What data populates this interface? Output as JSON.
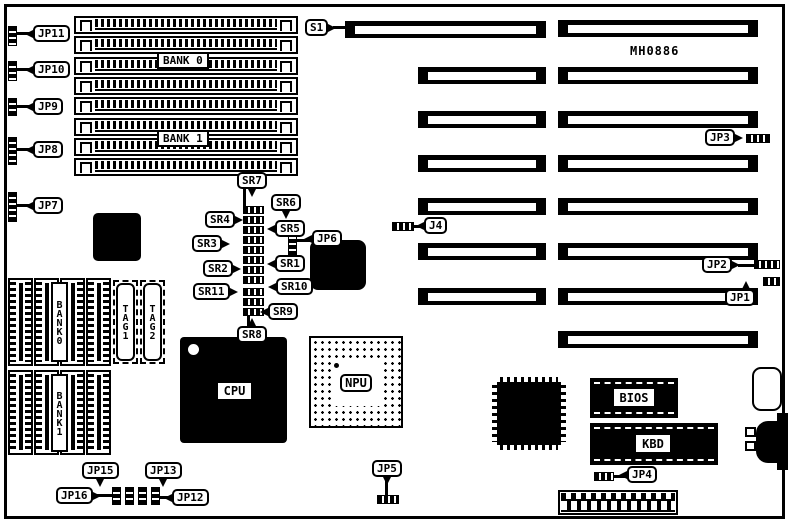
{
  "board": {
    "part_number": "MH0886"
  },
  "callouts": {
    "s1": "S1",
    "j4": "J4",
    "jp1": "JP1",
    "jp2": "JP2",
    "jp3": "JP3",
    "jp4": "JP4",
    "jp5": "JP5",
    "jp6": "JP6",
    "jp7": "JP7",
    "jp8": "JP8",
    "jp9": "JP9",
    "jp10": "JP10",
    "jp11": "JP11",
    "jp12": "JP12",
    "jp13": "JP13",
    "jp15": "JP15",
    "jp16": "JP16"
  },
  "resistor_packs": {
    "sr1": "SR1",
    "sr2": "SR2",
    "sr3": "SR3",
    "sr4": "SR4",
    "sr5": "SR5",
    "sr6": "SR6",
    "sr7": "SR7",
    "sr8": "SR8",
    "sr9": "SR9",
    "sr10": "SR10",
    "sr11": "SR11"
  },
  "memory": {
    "simm_bank0": "BANK 0",
    "simm_bank1": "BANK 1",
    "cache_bank0": "BANK0",
    "cache_bank1": "BANK1",
    "tag1": "TAG1",
    "tag2": "TAG2"
  },
  "chips": {
    "cpu": "CPU",
    "npu": "NPU",
    "bios": "BIOS",
    "kbd": "KBD"
  }
}
